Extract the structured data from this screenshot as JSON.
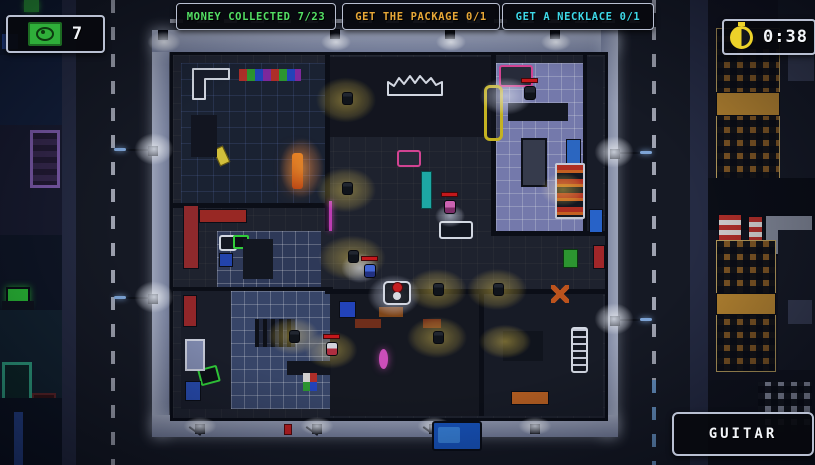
{
  "hud": {
    "money": {
      "value": "7",
      "icon": "money-bill-icon",
      "accent": "#2fae3a"
    },
    "objectives": [
      {
        "label": "MONEY COLLECTED",
        "progress": "7/23",
        "color": "#54e065"
      },
      {
        "label": "GET THE PACKAGE",
        "progress": "0/1",
        "color": "#e8a838"
      },
      {
        "label": "GET A NECKLACE",
        "progress": "0/1",
        "color": "#3ed8e8"
      }
    ],
    "timer": {
      "value": "0:38",
      "icon": "stopwatch-icon",
      "accent": "#ecd229"
    },
    "item_slot": {
      "label": "GUITAR"
    }
  },
  "scene": {
    "light_pool_color": "#d8b830",
    "sidewalk_glow_color": "#cdd4e6",
    "player_accent": "#d81f1f",
    "alert_bar_color": "#d81818"
  }
}
